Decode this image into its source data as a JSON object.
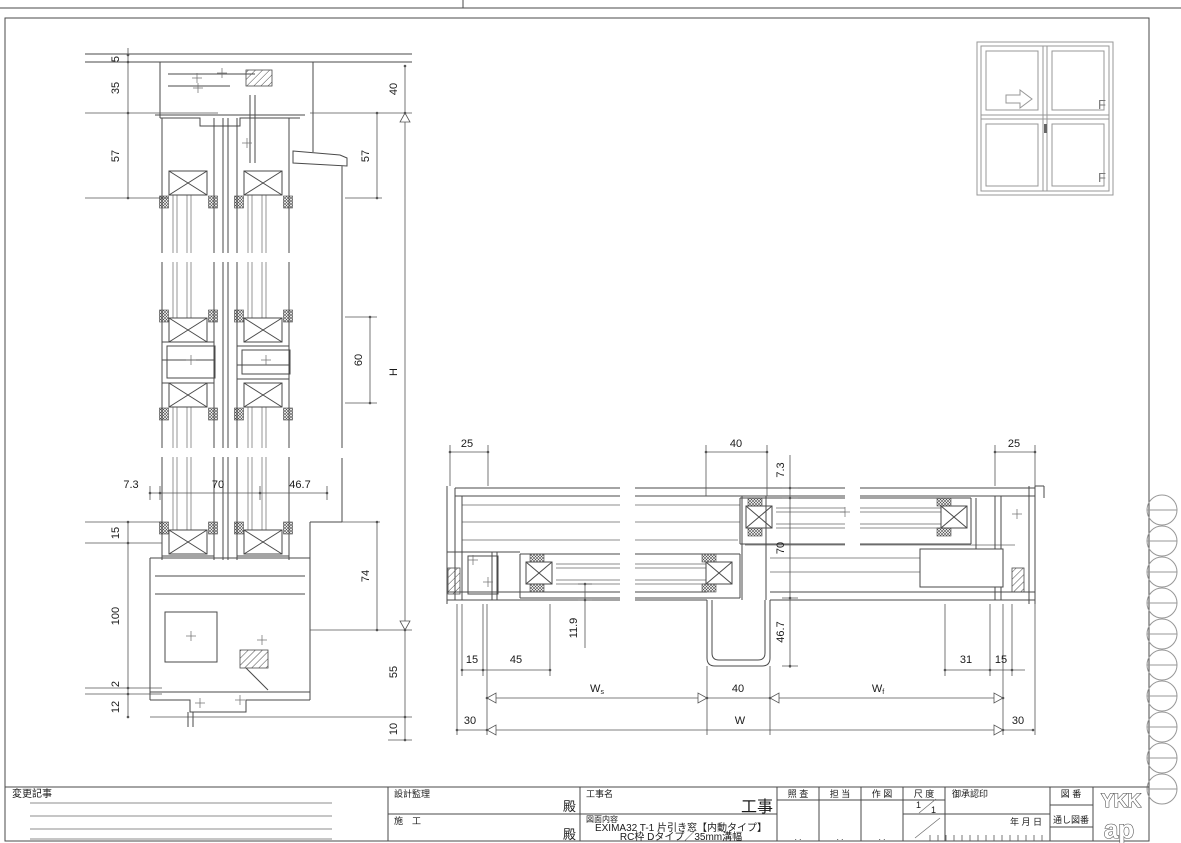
{
  "vs": {
    "d5": "5",
    "d35": "35",
    "d57l": "57",
    "d15": "15",
    "d100": "100",
    "d2": "2",
    "d12": "12",
    "d73": "7.3",
    "d70": "70",
    "d467": "46.7",
    "d40": "40",
    "d57r": "57",
    "dH": "H",
    "d60": "60",
    "d74": "74",
    "d55": "55",
    "d10": "10"
  },
  "hs": {
    "d25l": "25",
    "d40t": "40",
    "d25r": "25",
    "d73": "7.3",
    "d70": "70",
    "d467": "46.7",
    "d119": "11.9",
    "d15l": "15",
    "d45": "45",
    "d31": "31",
    "d15r": "15",
    "dWs_base": "W",
    "dWs_sub": "s",
    "d40b": "40",
    "dWf_base": "W",
    "dWf_sub": "f",
    "d30l": "30",
    "dW": "W",
    "d30r": "30"
  },
  "elev": {
    "f_top": "F",
    "f_bottom": "F"
  },
  "tb": {
    "change_notes": "変更記事",
    "design_supervision": "設計監理",
    "construction": "施　工",
    "dono1": "殿",
    "dono2": "殿",
    "project_name_label": "工事名",
    "project_suffix": "工事",
    "drawing_content_label": "図面内容",
    "content_line1": "EXIMA32 T-1 片引き窓【内動タイプ】",
    "content_line2": "RC枠 Dタイプ／35mm溝幅",
    "check": "照 査",
    "in_charge": "担 当",
    "drafting": "作 図",
    "scale_label": "尺 度",
    "scale_num": "1",
    "scale_den": "1",
    "approval_label": "御承認印",
    "date_label": "年 月 日",
    "drawing_no_label": "図 番",
    "serial_no_label": "通し図番",
    "cell_dots": ". .",
    "logo_top": "YKK",
    "logo_bottom": "ap"
  },
  "colors": {
    "line": "#4a4a4a",
    "dim": "#555555",
    "light": "#979797"
  }
}
